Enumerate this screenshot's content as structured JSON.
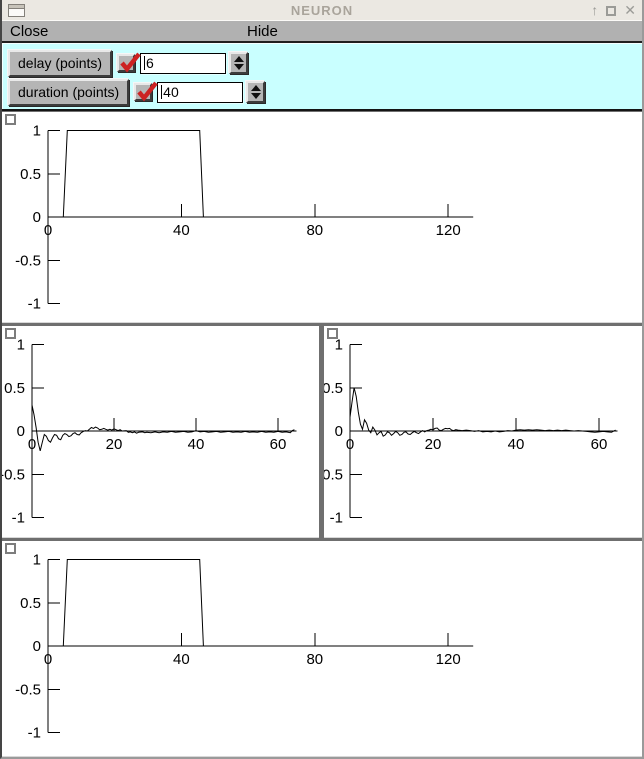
{
  "window": {
    "title": "NEURON",
    "icons": {
      "minimize": "↑",
      "close": "✕"
    }
  },
  "menubar": {
    "close": "Close",
    "hide": "Hide"
  },
  "controls": {
    "params": [
      {
        "label": "delay (points)",
        "checked": true,
        "value": "6"
      },
      {
        "label": "duration (points)",
        "checked": true,
        "value": "40"
      }
    ]
  },
  "colors": {
    "panel_bg": "#c9ffff",
    "check_red": "#cc2222",
    "titlebar_bg": "#ebe8e2",
    "menubar_bg": "#b1b1b1",
    "graph_bg": "#ffffff",
    "curve": "#000000"
  },
  "chart_data": [
    {
      "name": "stimulus-pulse",
      "type": "line",
      "title": "",
      "xlabel": "",
      "ylabel": "",
      "xlim": [
        0,
        127.5
      ],
      "ylim": [
        -1,
        1
      ],
      "x_ticks": [
        0,
        40,
        80,
        120
      ],
      "y_ticks": [
        1,
        0.5,
        0,
        -0.5,
        -1
      ],
      "grid": false,
      "legend": "none",
      "points": [
        [
          0,
          0
        ],
        [
          4.6,
          0
        ],
        [
          5.8,
          1
        ],
        [
          45.5,
          1
        ],
        [
          46.6,
          0
        ],
        [
          127.5,
          0
        ]
      ]
    },
    {
      "name": "spectrum-left",
      "type": "line",
      "title": "",
      "xlabel": "",
      "ylabel": "",
      "xlim": [
        0,
        64.5
      ],
      "ylim": [
        -1,
        1
      ],
      "x_ticks": [
        0,
        20,
        40,
        60
      ],
      "y_ticks": [
        1,
        0.5,
        0,
        -0.5,
        -1
      ],
      "grid": false,
      "legend": "none",
      "points": [
        [
          0,
          0.3
        ],
        [
          0.5,
          0.19
        ],
        [
          1,
          0.04
        ],
        [
          1.5,
          -0.13
        ],
        [
          2,
          -0.23
        ],
        [
          2.5,
          -0.13
        ],
        [
          3,
          -0.04
        ],
        [
          3.5,
          -0.06
        ],
        [
          4,
          -0.11
        ],
        [
          4.5,
          -0.13
        ],
        [
          5,
          -0.08
        ],
        [
          5.5,
          -0.04
        ],
        [
          6,
          -0.05
        ],
        [
          6.5,
          -0.09
        ],
        [
          7,
          -0.1
        ],
        [
          7.5,
          -0.05
        ],
        [
          8,
          -0.03
        ],
        [
          8.5,
          -0.04
        ],
        [
          9,
          -0.065
        ],
        [
          9.5,
          -0.055
        ],
        [
          10,
          -0.03
        ],
        [
          10.5,
          -0.02
        ],
        [
          11,
          -0.04
        ],
        [
          11.5,
          -0.045
        ],
        [
          12,
          -0.02
        ],
        [
          12.5,
          -0.005
        ],
        [
          13,
          0.005
        ],
        [
          13.5,
          0
        ],
        [
          14,
          0.02
        ],
        [
          14.5,
          0.04
        ],
        [
          15,
          0.03
        ],
        [
          15.5,
          0.045
        ],
        [
          16,
          0.035
        ],
        [
          16.5,
          0.015
        ],
        [
          17,
          0.02
        ],
        [
          17.5,
          0.03
        ],
        [
          18,
          0.02
        ],
        [
          18.5,
          0.01
        ],
        [
          19,
          0.02
        ],
        [
          19.5,
          0.01
        ],
        [
          20,
          0.025
        ],
        [
          21,
          0.005
        ],
        [
          21.5,
          0.015
        ],
        [
          22,
          0
        ],
        [
          23,
          0.005
        ],
        [
          23.5,
          -0.015
        ],
        [
          24,
          -0.01
        ],
        [
          24.5,
          -0.02
        ],
        [
          25,
          -0.01
        ],
        [
          25.5,
          -0.025
        ],
        [
          26,
          -0.015
        ],
        [
          27,
          -0.01
        ],
        [
          27.5,
          -0.02
        ],
        [
          28,
          -0.015
        ],
        [
          29,
          -0.02
        ],
        [
          30,
          -0.01
        ],
        [
          31,
          -0.02
        ],
        [
          32,
          -0.01
        ],
        [
          33,
          -0.015
        ],
        [
          34,
          -0.005
        ],
        [
          35,
          -0.015
        ],
        [
          36,
          -0.01
        ],
        [
          37,
          -0.005
        ],
        [
          38,
          -0.015
        ],
        [
          39,
          -0.01
        ],
        [
          40,
          0.005
        ],
        [
          41,
          -0.01
        ],
        [
          42,
          -0.005
        ],
        [
          43,
          -0.015
        ],
        [
          44,
          -0.01
        ],
        [
          45,
          -0.005
        ],
        [
          46,
          -0.015
        ],
        [
          47,
          -0.01
        ],
        [
          48,
          -0.005
        ],
        [
          49,
          -0.015
        ],
        [
          50,
          -0.01
        ],
        [
          51,
          -0.015
        ],
        [
          52,
          -0.005
        ],
        [
          53,
          -0.015
        ],
        [
          54,
          -0.01
        ],
        [
          55,
          -0.015
        ],
        [
          56,
          -0.005
        ],
        [
          57,
          -0.015
        ],
        [
          58,
          -0.01
        ],
        [
          59,
          -0.015
        ],
        [
          60,
          -0.005
        ],
        [
          61,
          -0.015
        ],
        [
          62,
          -0.01
        ],
        [
          63,
          -0.02
        ],
        [
          63.5,
          0.005
        ],
        [
          64,
          0.015
        ]
      ]
    },
    {
      "name": "spectrum-right",
      "type": "line",
      "title": "",
      "xlabel": "",
      "ylabel": "",
      "xlim": [
        0,
        64.5
      ],
      "ylim": [
        -1,
        1
      ],
      "x_ticks": [
        0,
        20,
        40,
        60
      ],
      "y_ticks": [
        1,
        0.5,
        0,
        -0.5,
        -1
      ],
      "grid": false,
      "legend": "none",
      "points": [
        [
          0,
          0.16
        ],
        [
          0.5,
          0.34
        ],
        [
          1,
          0.5
        ],
        [
          1.5,
          0.4
        ],
        [
          2,
          0.22
        ],
        [
          2.5,
          0.08
        ],
        [
          3,
          0.02
        ],
        [
          3.5,
          0.13
        ],
        [
          4,
          0.09
        ],
        [
          4.5,
          0.01
        ],
        [
          5,
          -0.02
        ],
        [
          5.5,
          0.045
        ],
        [
          6,
          0.01
        ],
        [
          6.5,
          -0.045
        ],
        [
          7,
          -0.02
        ],
        [
          7.5,
          -0.005
        ],
        [
          8,
          -0.06
        ],
        [
          8.5,
          -0.045
        ],
        [
          9,
          -0.01
        ],
        [
          9.5,
          -0.02
        ],
        [
          10,
          -0.05
        ],
        [
          10.5,
          -0.03
        ],
        [
          11,
          -0.005
        ],
        [
          11.5,
          -0.02
        ],
        [
          12,
          -0.05
        ],
        [
          12.5,
          -0.04
        ],
        [
          13,
          -0.015
        ],
        [
          13.5,
          -0.01
        ],
        [
          14,
          -0.035
        ],
        [
          14.5,
          -0.04
        ],
        [
          15,
          -0.02
        ],
        [
          15.5,
          -0.005
        ],
        [
          16,
          -0.02
        ],
        [
          16.5,
          -0.03
        ],
        [
          17,
          -0.01
        ],
        [
          17.5,
          0.005
        ],
        [
          18,
          -0.01
        ],
        [
          18.5,
          0.005
        ],
        [
          19,
          0.01
        ],
        [
          19.5,
          0.02
        ],
        [
          20,
          0.015
        ],
        [
          20.5,
          0.03
        ],
        [
          21,
          0.035
        ],
        [
          21.5,
          0.01
        ],
        [
          22,
          0.005
        ],
        [
          22.5,
          0.02
        ],
        [
          23,
          0.03
        ],
        [
          23.5,
          0.025
        ],
        [
          24,
          0.03
        ],
        [
          24.5,
          0.01
        ],
        [
          25,
          0.005
        ],
        [
          25.5,
          0.015
        ],
        [
          26,
          0.01
        ],
        [
          27,
          0.005
        ],
        [
          28,
          0.01
        ],
        [
          29,
          0.005
        ],
        [
          30,
          -0.005
        ],
        [
          31,
          0.005
        ],
        [
          32,
          -0.01
        ],
        [
          33,
          -0.005
        ],
        [
          34,
          -0.01
        ],
        [
          35,
          0
        ],
        [
          36,
          -0.01
        ],
        [
          37,
          -0.005
        ],
        [
          38,
          0.005
        ],
        [
          39,
          0
        ],
        [
          40,
          0.01
        ],
        [
          41,
          0.015
        ],
        [
          42,
          0.01
        ],
        [
          43,
          0.015
        ],
        [
          44,
          0.01
        ],
        [
          45,
          0.015
        ],
        [
          46,
          0.01
        ],
        [
          47,
          0.005
        ],
        [
          48,
          0.01
        ],
        [
          49,
          0.005
        ],
        [
          50,
          0.01
        ],
        [
          51,
          0.005
        ],
        [
          52,
          0.01
        ],
        [
          53,
          0.005
        ],
        [
          54,
          0
        ],
        [
          55,
          0.005
        ],
        [
          56,
          0
        ],
        [
          57,
          -0.005
        ],
        [
          58,
          -0.01
        ],
        [
          59,
          -0.015
        ],
        [
          60,
          -0.01
        ],
        [
          61,
          -0.005
        ],
        [
          62,
          -0.01
        ],
        [
          63,
          -0.015
        ],
        [
          64,
          0.01
        ]
      ]
    },
    {
      "name": "reconstructed-pulse",
      "type": "line",
      "title": "",
      "xlabel": "",
      "ylabel": "",
      "xlim": [
        0,
        127.5
      ],
      "ylim": [
        -1,
        1
      ],
      "x_ticks": [
        0,
        40,
        80,
        120
      ],
      "y_ticks": [
        1,
        0.5,
        0,
        -0.5,
        -1
      ],
      "grid": false,
      "legend": "none",
      "points": [
        [
          0,
          0
        ],
        [
          4.6,
          0
        ],
        [
          5.8,
          1
        ],
        [
          45.5,
          1
        ],
        [
          46.6,
          0
        ],
        [
          127.5,
          0
        ]
      ]
    }
  ]
}
